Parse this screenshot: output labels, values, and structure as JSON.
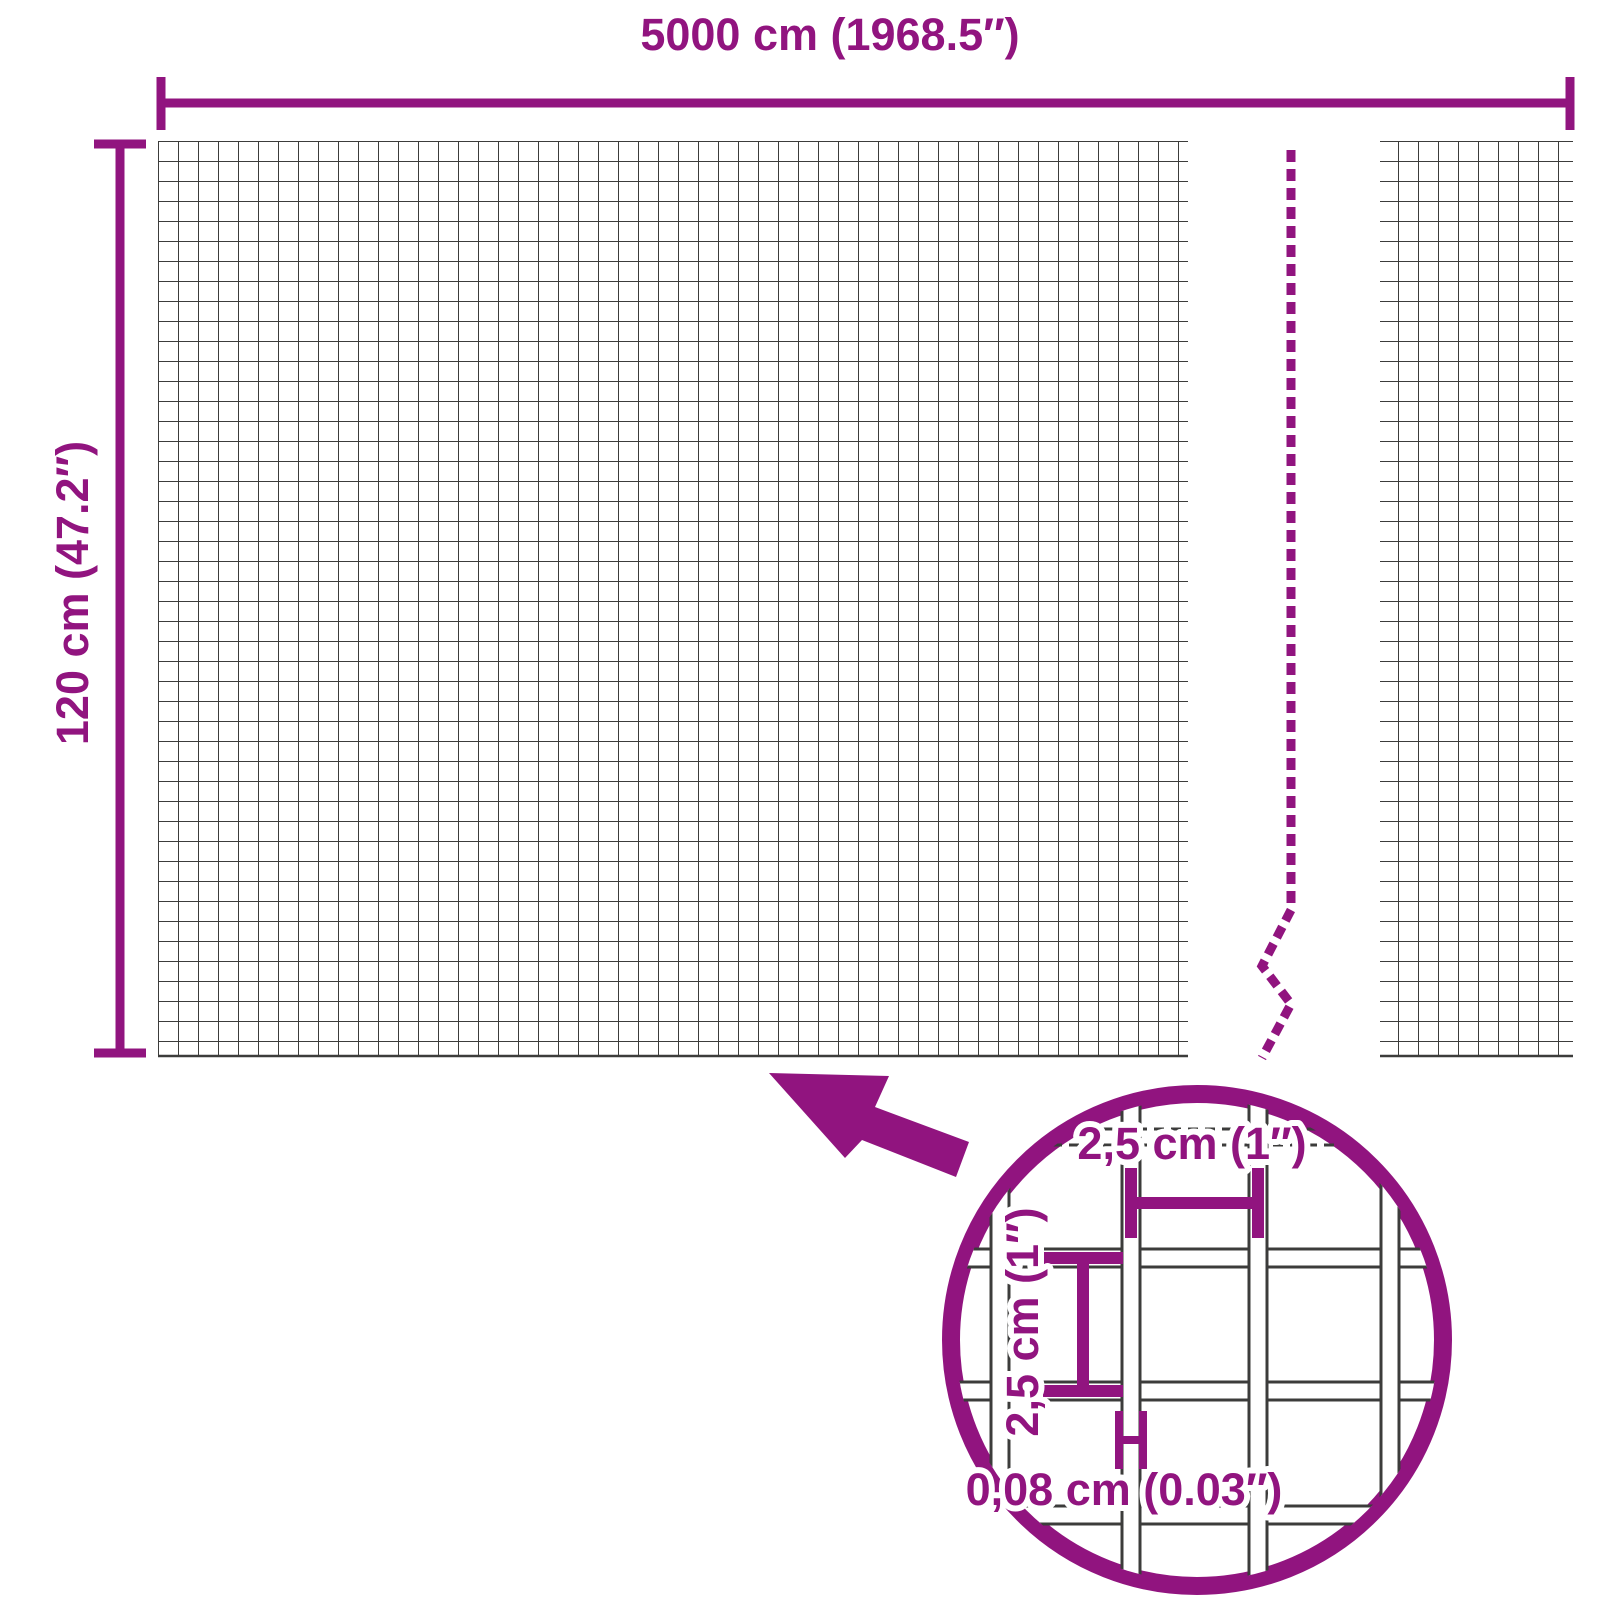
{
  "diagram": {
    "kind": "product-dimension-diagram"
  },
  "overall_dimensions": {
    "width_label": "5000 cm (1968.5″)",
    "height_label": "120 cm (47.2″)"
  },
  "mesh_detail": {
    "cell_width_label": "2,5 cm (1″)",
    "cell_height_label": "2,5 cm (1″)",
    "wire_thickness_label": "0,08 cm (0.03″)"
  },
  "colors": {
    "accent": "#91147F",
    "mesh_line": "#3C3C3B",
    "background": "#FFFFFF",
    "wire_fill": "#FFFFFF"
  }
}
